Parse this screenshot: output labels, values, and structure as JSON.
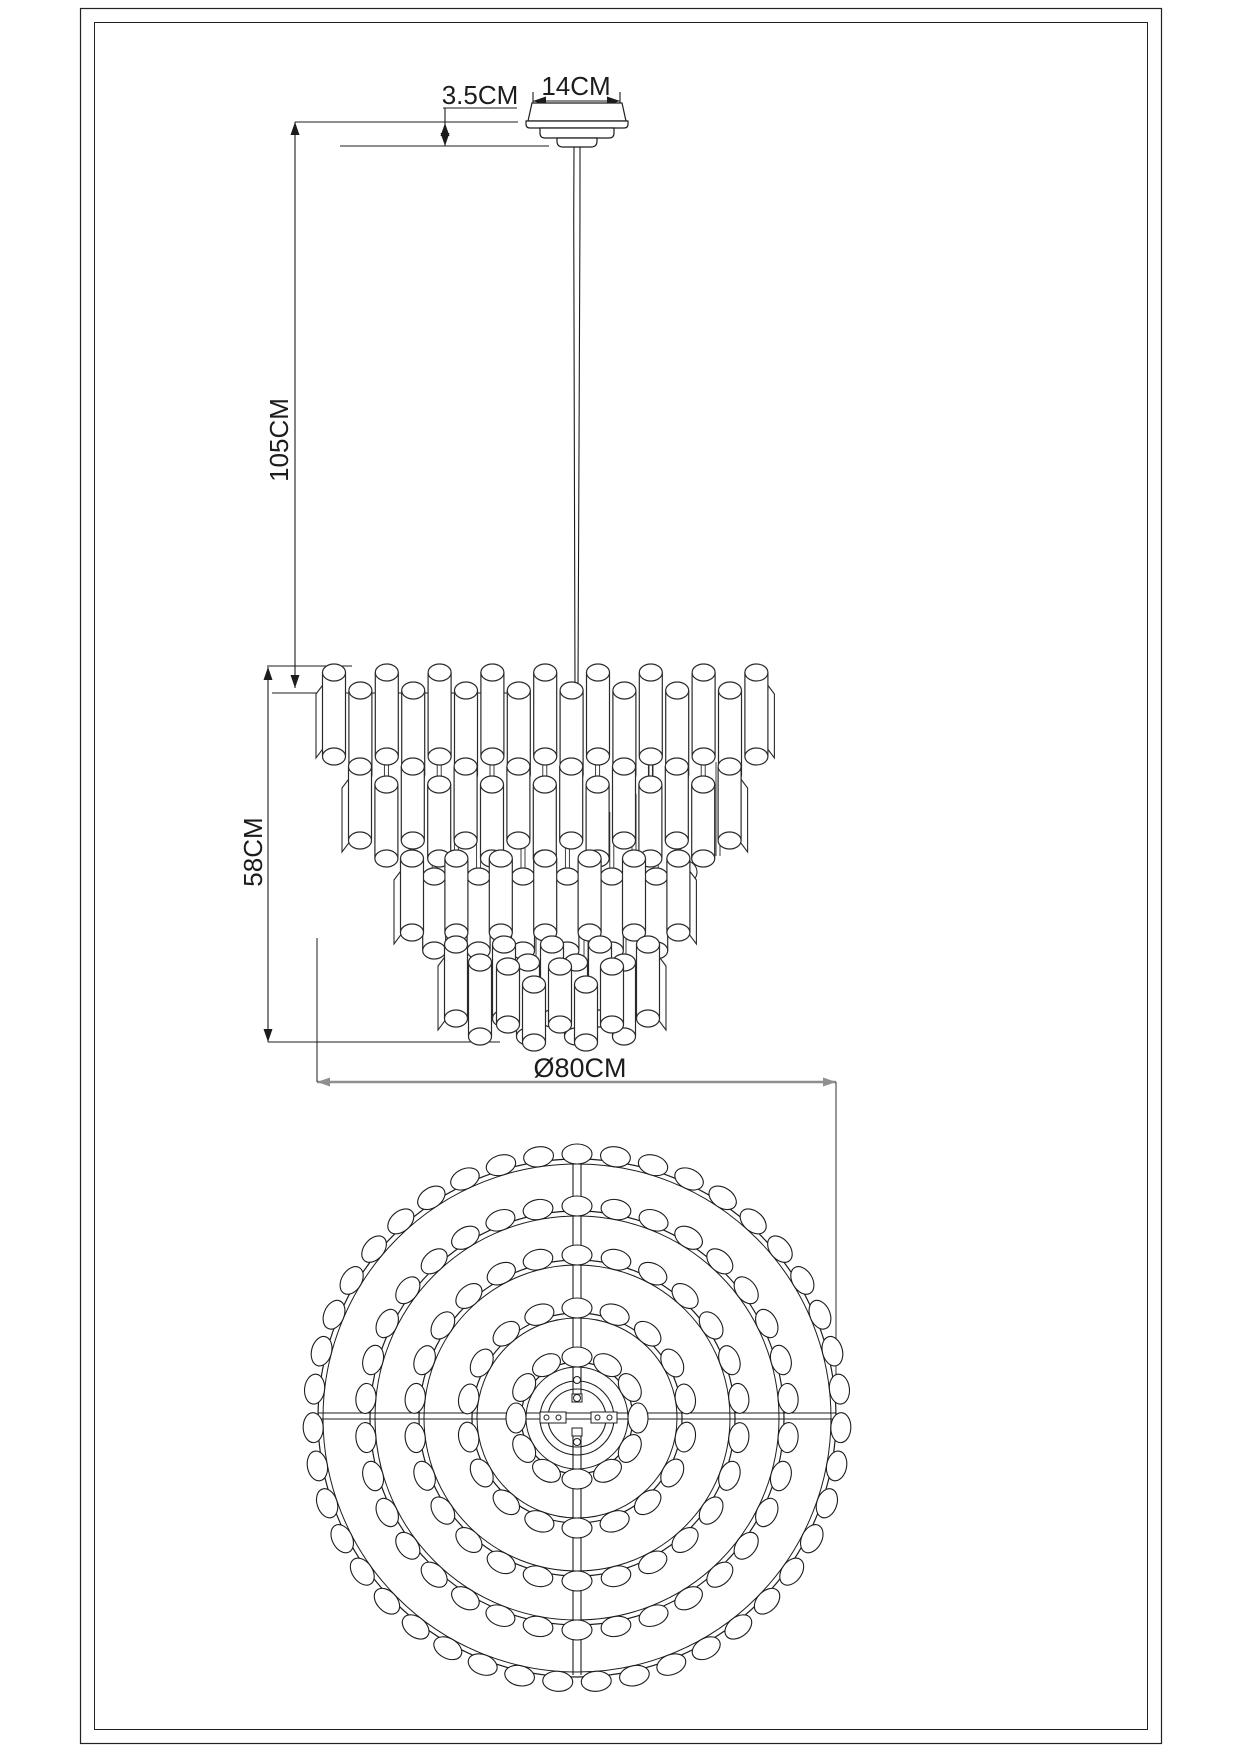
{
  "title": "Chandelier technical dimension drawing",
  "colors": {
    "line": "#1c1c1c",
    "tube_line": "#2a2a2a",
    "dim_gray": "#8f8f8f",
    "background": "#ffffff"
  },
  "dimensions": {
    "canopy_height": {
      "label": "3.5CM"
    },
    "canopy_width": {
      "label": "14CM"
    },
    "suspension_length": {
      "label": "105CM"
    },
    "body_height": {
      "label": "58CM"
    },
    "body_diameter": {
      "label": "Ø80CM"
    }
  },
  "front_view": {
    "tiers": [
      {
        "tubes": 17,
        "x_start": 334,
        "x_step": 26.4,
        "top_y": 664,
        "tube_len": 84
      },
      {
        "tubes": 15,
        "x_start": 360,
        "x_step": 26.4,
        "top_y": 758,
        "tube_len": 74
      },
      {
        "tubes": 13,
        "x_start": 412,
        "x_step": 22.2,
        "top_y": 850,
        "tube_len": 74
      },
      {
        "tubes": 9,
        "x_start": 456,
        "x_step": 24.0,
        "top_y": 936,
        "tube_len": 74
      },
      {
        "tubes": 5,
        "x_start": 508,
        "x_step": 26.0,
        "top_y": 958,
        "tube_len": 58
      }
    ],
    "tube_width": 23,
    "row_offset": 18
  },
  "plan_view": {
    "center_x": 577,
    "center_y": 1418,
    "rings": [
      {
        "radius": 259,
        "beads": 43
      },
      {
        "radius": 207,
        "beads": 34
      },
      {
        "radius": 158,
        "beads": 26
      },
      {
        "radius": 105,
        "beads": 18
      },
      {
        "radius": 56,
        "beads": 12
      }
    ],
    "center_circles": [
      37,
      29
    ]
  }
}
